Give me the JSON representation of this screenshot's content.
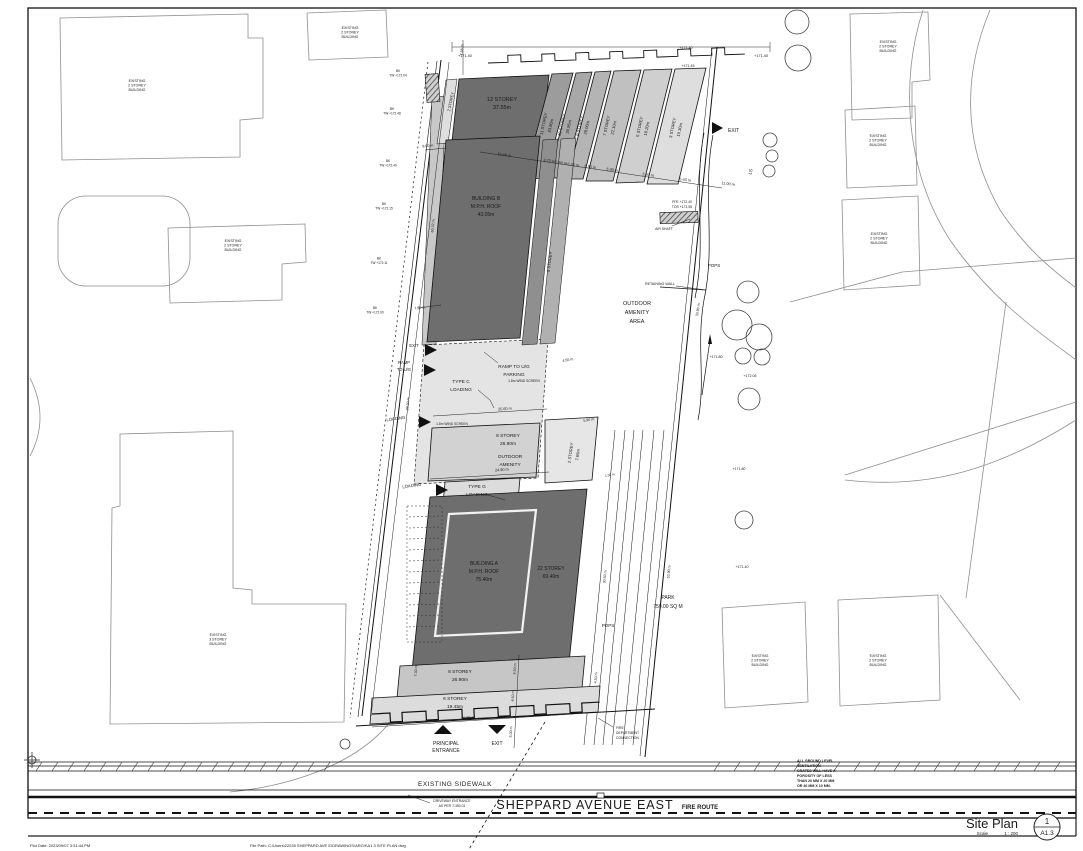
{
  "sheet": {
    "title": "Site Plan",
    "scale_label": "Scale",
    "scale_value": "1 : 200",
    "detail_number": "1",
    "sheet_number": "A1.3",
    "plot_stamp_left": "Plot Date: 2023/09/07 3:31:44 PM",
    "plot_stamp_right": "File Path: C:\\Users\\22035 SHEPPARD AVE E\\DRAWINGS\\ARCH\\A1.3 SITE PLAN.dwg"
  },
  "streets": {
    "main": "SHEPPARD AVENUE EAST",
    "fire_route": "FIRE ROUTE",
    "sidewalk": "EXISTING SIDEWALK",
    "driveway_line1": "DRIVEWAY ENTRANCE",
    "driveway_line2": "AS PER T-350.01"
  },
  "site": {
    "b12": [
      "12 STOREY",
      "37.55m"
    ],
    "b11": [
      "11 STOREY",
      "33.90m"
    ],
    "b10": [
      "10 STOREY",
      "30.95m"
    ],
    "b9": [
      "9 STOREY",
      "28.00m"
    ],
    "b7": [
      "7 STOREY",
      "22.10m"
    ],
    "b5": [
      "5 STOREY",
      "16.20m"
    ],
    "b3": [
      "3 STOREY",
      "10.30m"
    ],
    "b2strip": "2 STOREY",
    "b9band": "9 STOREY",
    "buildingB": [
      "BUILDING B",
      "M.P.H. ROOF",
      "43.05m"
    ],
    "buildingA": [
      "BUILDING A",
      "M.P.H. ROOF",
      "75.40m"
    ],
    "b22": [
      "22 STOREY",
      "69.40m"
    ],
    "b8mid": [
      "8 STOREY",
      "26.90m"
    ],
    "b2wing": [
      "2 STOREY",
      "7.65m"
    ],
    "b8south": [
      "8 STOREY",
      "26.90m"
    ],
    "b6south": [
      "6 STOREY",
      "19.45m"
    ],
    "outdoor_amenity_area": [
      "OUTDOOR",
      "AMENITY",
      "AREA"
    ],
    "outdoor_amenity": [
      "OUTDOOR",
      "AMENITY"
    ],
    "park": [
      "PARK",
      "759.00 SQ M"
    ],
    "pops": "POPS",
    "ramp_ug": [
      "RAMP TO U/G",
      "PARKING"
    ],
    "ramp_to_ug": [
      "RAMP",
      "TO U/G"
    ],
    "type_c": [
      "TYPE C",
      "LOADING"
    ],
    "type_g": [
      "TYPE G",
      "LOADING"
    ],
    "loading": "LOADING",
    "exit": "EXIT",
    "wind_screen": "1.8m WIND SCREEN",
    "retaining_wall": "RETAINING WALL",
    "air_shaft": "AIR SHAFT",
    "ffe": "FFE +172.40",
    "tos": "TOS +171.55",
    "principal_entrance": [
      "PRINCIPAL",
      "ENTRANCE"
    ],
    "fire_dept": [
      "FIRE",
      "DEPARTMENT",
      "CONNECTION"
    ],
    "ls": "LS"
  },
  "surroundings": {
    "existing2": [
      "EXISTING",
      "2 STOREY",
      "BUILDING"
    ],
    "existing3": [
      "EXISTING",
      "3 STOREY",
      "BUILDING"
    ]
  },
  "note": [
    "ALL GROUND LEVEL",
    "VENTILATION",
    "GRATES WILL HAVE A",
    "POROSITY OF LESS",
    "THAN 20 MM X 20 MM",
    "OR 40 MM X 10 MM."
  ],
  "dims": {
    "top_row": [
      "15.48 m",
      "3.73 m",
      "5.50 m",
      "5.35 m",
      "5.90 m",
      "5.90 m",
      "5.90 m",
      "5.40 m",
      "11.00 m"
    ],
    "west": [
      "8.00 m",
      "60.32 m",
      "7.50 m",
      "23.30 m",
      "7.68 m"
    ],
    "mid": [
      "25.60 m",
      "24.90 m",
      "4.50 m",
      "5.90 m",
      "1.50 m"
    ],
    "south": [
      "36.30 m",
      "7.30 m",
      "4.50 m",
      "4.50 m",
      "5.00 m",
      "4.50 m"
    ],
    "east": [
      "30.50 m",
      "53.90 m",
      "33.90 m"
    ]
  },
  "elevations": {
    "top_left": "+171.40",
    "top_right": "+171.40",
    "top_inner1": "+171.40",
    "top_inner2": "+171.45",
    "bk": [
      "BK",
      "TW +172.04",
      "TW +172.48",
      "TW +172.40",
      "TW +172.15",
      "TW +172.11",
      "TW +172.00"
    ],
    "east1": "+171.80",
    "east2": "+172.05",
    "east3": "+171.80",
    "east4": "+171.40"
  }
}
